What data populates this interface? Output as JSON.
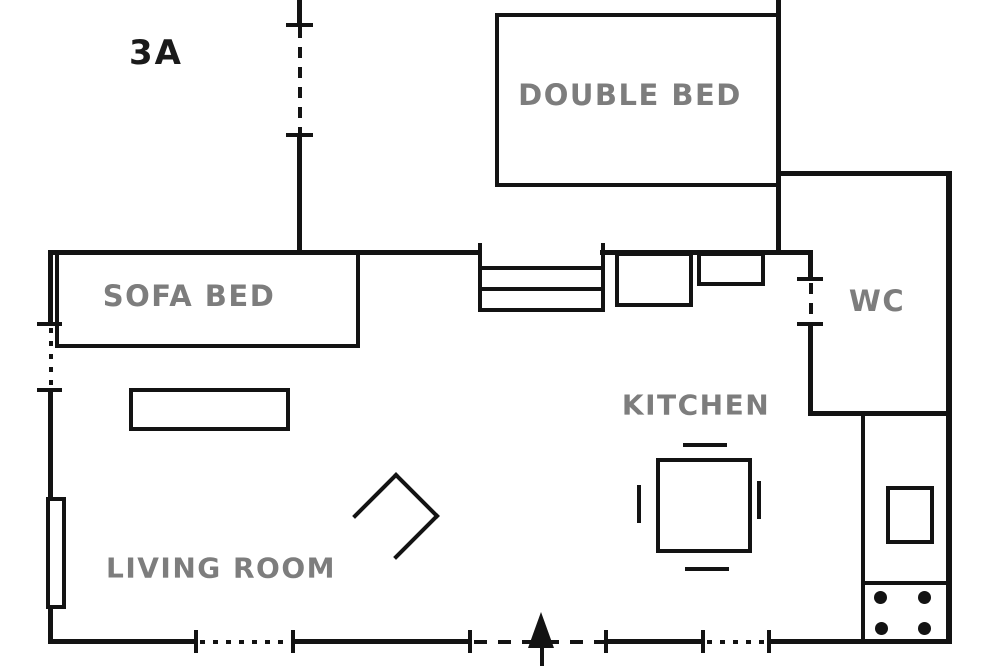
{
  "plan": {
    "unit_label": "3A",
    "rooms": [
      {
        "name": "double-bed-room",
        "label": "DOUBLE BED"
      },
      {
        "name": "sofa-bed-area",
        "label": "SOFA BED"
      },
      {
        "name": "wc",
        "label": "WC"
      },
      {
        "name": "kitchen",
        "label": "KITCHEN"
      },
      {
        "name": "living-room",
        "label": "LIVING ROOM"
      }
    ],
    "furniture_symbols": [
      "double-bed-icon",
      "sofa-bed-icon",
      "coffee-table-icon",
      "armchair-icon",
      "dining-table-icon",
      "chair-mark-icon",
      "sink-counter-icon",
      "kitchen-counter-icon",
      "fridge-icon",
      "stove-burners-icon",
      "window-icon"
    ],
    "door_symbols": [
      "dashed-door-opening-icon",
      "entrance-arrow-icon"
    ],
    "colors": {
      "wall": "#131313",
      "room_label": "#7d7d7d",
      "unit_label": "#1a1a1a",
      "background": "#ffffff"
    }
  }
}
